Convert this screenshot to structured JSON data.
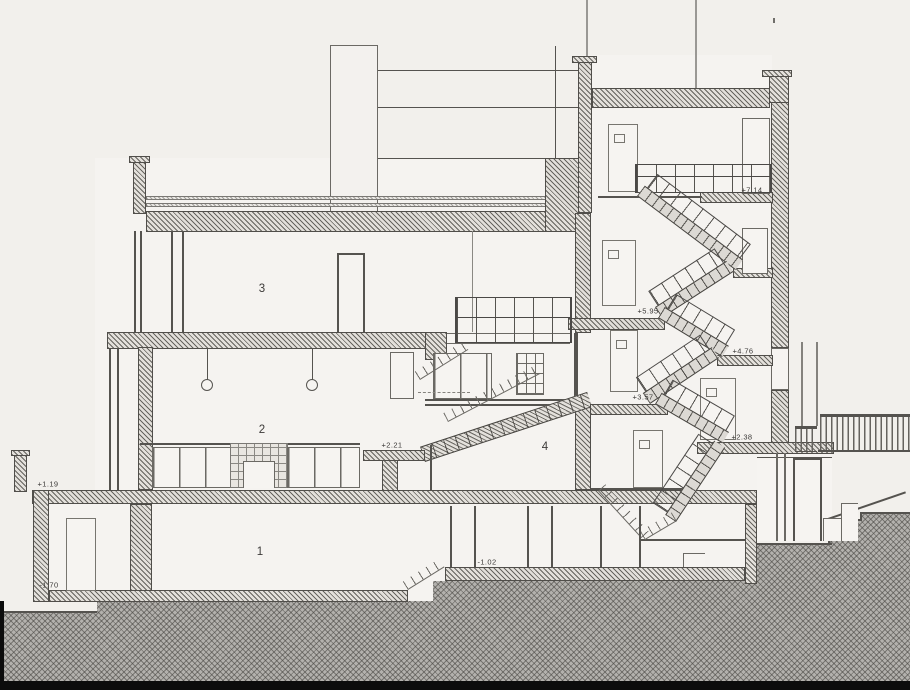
{
  "drawing": {
    "kind": "architectural cross-section",
    "labels": {
      "elevations": [
        {
          "text": "+7.14",
          "x": 752,
          "y": 190
        },
        {
          "text": "+5.95",
          "x": 648,
          "y": 311
        },
        {
          "text": "+4.76",
          "x": 743,
          "y": 351
        },
        {
          "text": "+3.57",
          "x": 643,
          "y": 397
        },
        {
          "text": "+2.38",
          "x": 742,
          "y": 437
        },
        {
          "text": "+2.21",
          "x": 392,
          "y": 445
        },
        {
          "text": "+1.19",
          "x": 48,
          "y": 484
        },
        {
          "text": "-1.02",
          "x": 487,
          "y": 562
        },
        {
          "text": "-1.70",
          "x": 49,
          "y": 585
        }
      ],
      "rooms": [
        {
          "text": "1",
          "x": 260,
          "y": 552
        },
        {
          "text": "2",
          "x": 262,
          "y": 430
        },
        {
          "text": "3",
          "x": 262,
          "y": 289
        },
        {
          "text": "4",
          "x": 545,
          "y": 447
        }
      ]
    },
    "colors": {
      "paper": "#f2f0ec",
      "ink": "#4a4846",
      "wall": "#e3e0db",
      "ground": "#b3b1ad",
      "bar": "#0c0c0c"
    }
  }
}
